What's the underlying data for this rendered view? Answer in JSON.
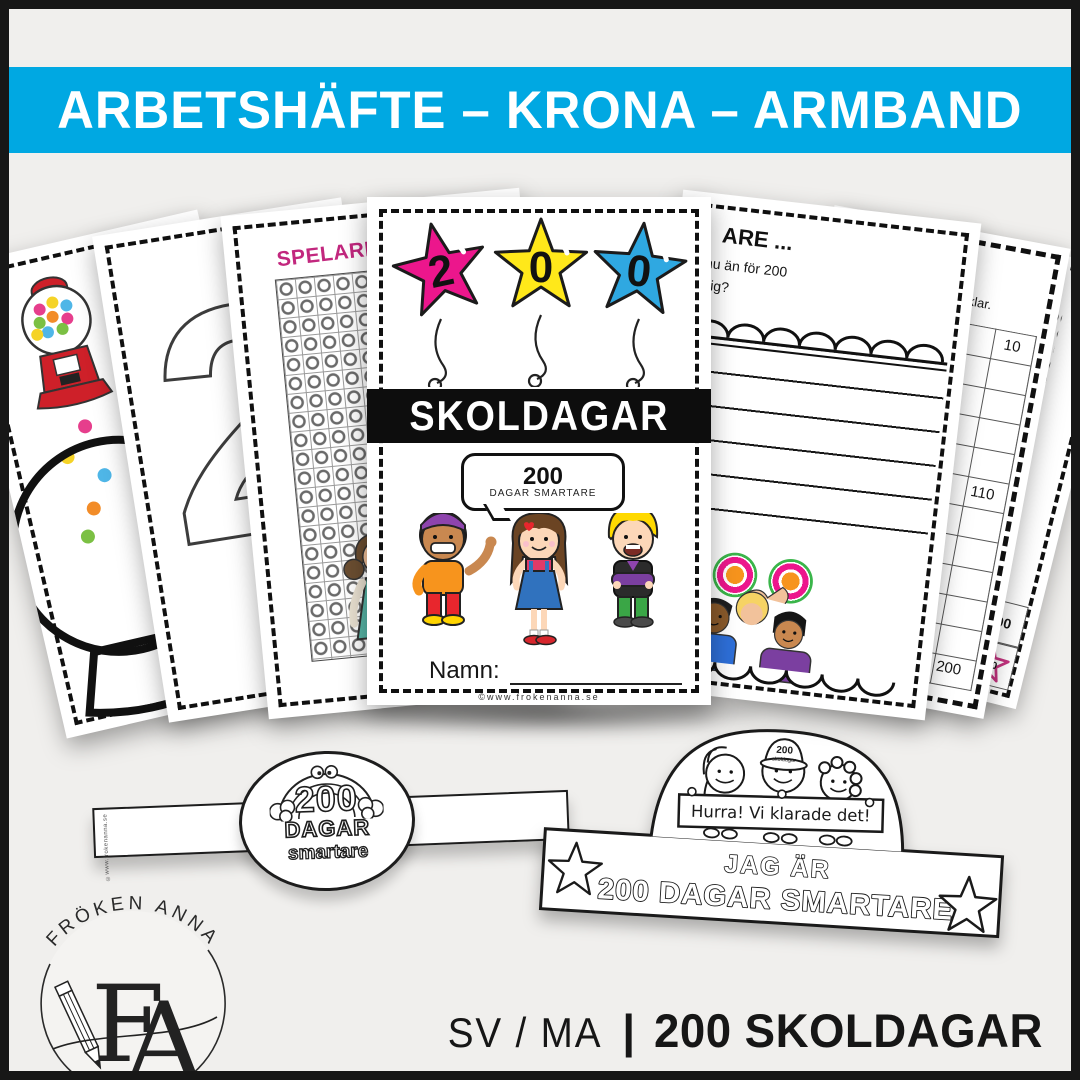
{
  "banner": {
    "text": "ARBETSHÄFTE – KRONA – ARMBAND"
  },
  "colors": {
    "banner_blue": "#00A8E2",
    "star_pink": "#EC168C",
    "star_yellow": "#FFE81A",
    "star_blue": "#2FA8E1",
    "spelare_pink": "#C2277E",
    "target_green": "#3AB54A",
    "target_orange": "#F7941D",
    "star200_pink": "#C4337F"
  },
  "pages": {
    "page1": {
      "instruction": "Rita"
    },
    "page2": {
      "instruction": "Rit",
      "big_number": "2"
    },
    "page3": {
      "title": "SPELARE 1"
    },
    "cover": {
      "star_digits": [
        "2",
        "0",
        "0"
      ],
      "title": "SKOLDAGAR",
      "bubble_number": "200",
      "bubble_caption": "DAGAR SMARTARE",
      "name_label": "Namn:",
      "footer": "©www.frokenanna.se"
    },
    "page5": {
      "title_fragment": "ARE ...",
      "text_line1": "nu än för 200",
      "text_line2": "dig?"
    },
    "page6": {
      "title_fragment": "TAN",
      "instruction_fragment": "äkna till 200 när du är klar.",
      "cell_10": "10",
      "cell_38": "38",
      "cell_110": "110",
      "cell_200": "200"
    },
    "page7": {
      "instruction_fragment": "i tiohopp.",
      "cell_80": "80",
      "cell_100": "100",
      "cell_star": "200"
    }
  },
  "bracelet": {
    "number": "200",
    "word1": "DAGAR",
    "word2": "smartare",
    "copyright": "©www.frokenanna.se"
  },
  "crown": {
    "cap_number": "200",
    "cap_word": "skoldagar",
    "banner_text": "Hurra! Vi klarade det!",
    "line1": "JAG ÄR",
    "line2": "200 DAGAR SMARTARE"
  },
  "logo": {
    "brand": "FRÖKEN ANNA",
    "monogram_f": "F",
    "monogram_a": "A"
  },
  "caption": {
    "subjects": "SV / MA",
    "divider": "|",
    "product": "200 SKOLDAGAR"
  }
}
